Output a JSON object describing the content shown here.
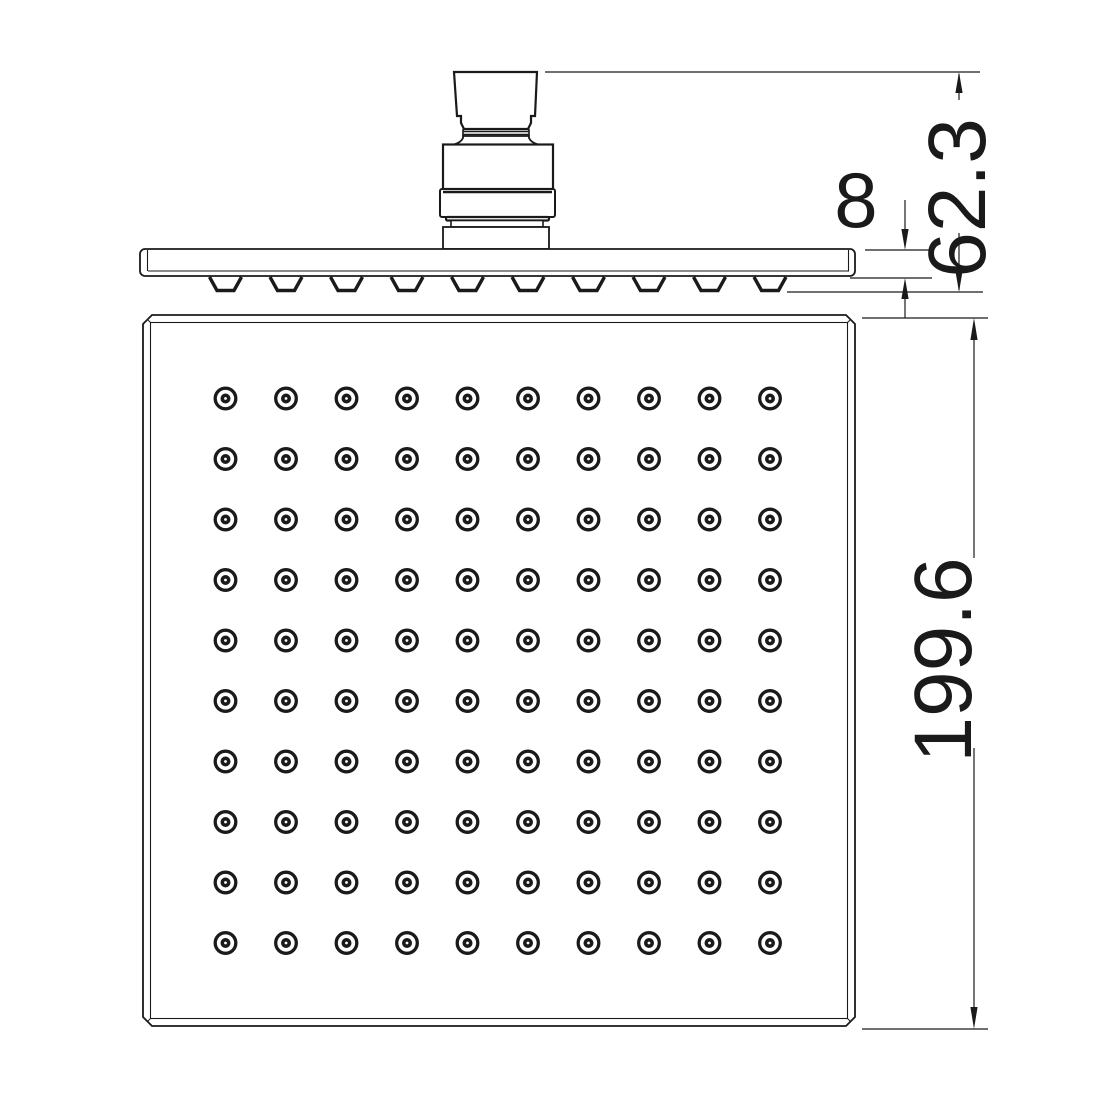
{
  "drawing": {
    "dimensions": {
      "connector_height": "62.3",
      "plate_thickness": "8",
      "face_size": "199.6"
    },
    "nozzle_grid": {
      "rows": 10,
      "cols": 10
    },
    "side_nozzles": {
      "count": 10
    },
    "colors": {
      "line": "#1a1a1a",
      "background": "#ffffff"
    }
  }
}
